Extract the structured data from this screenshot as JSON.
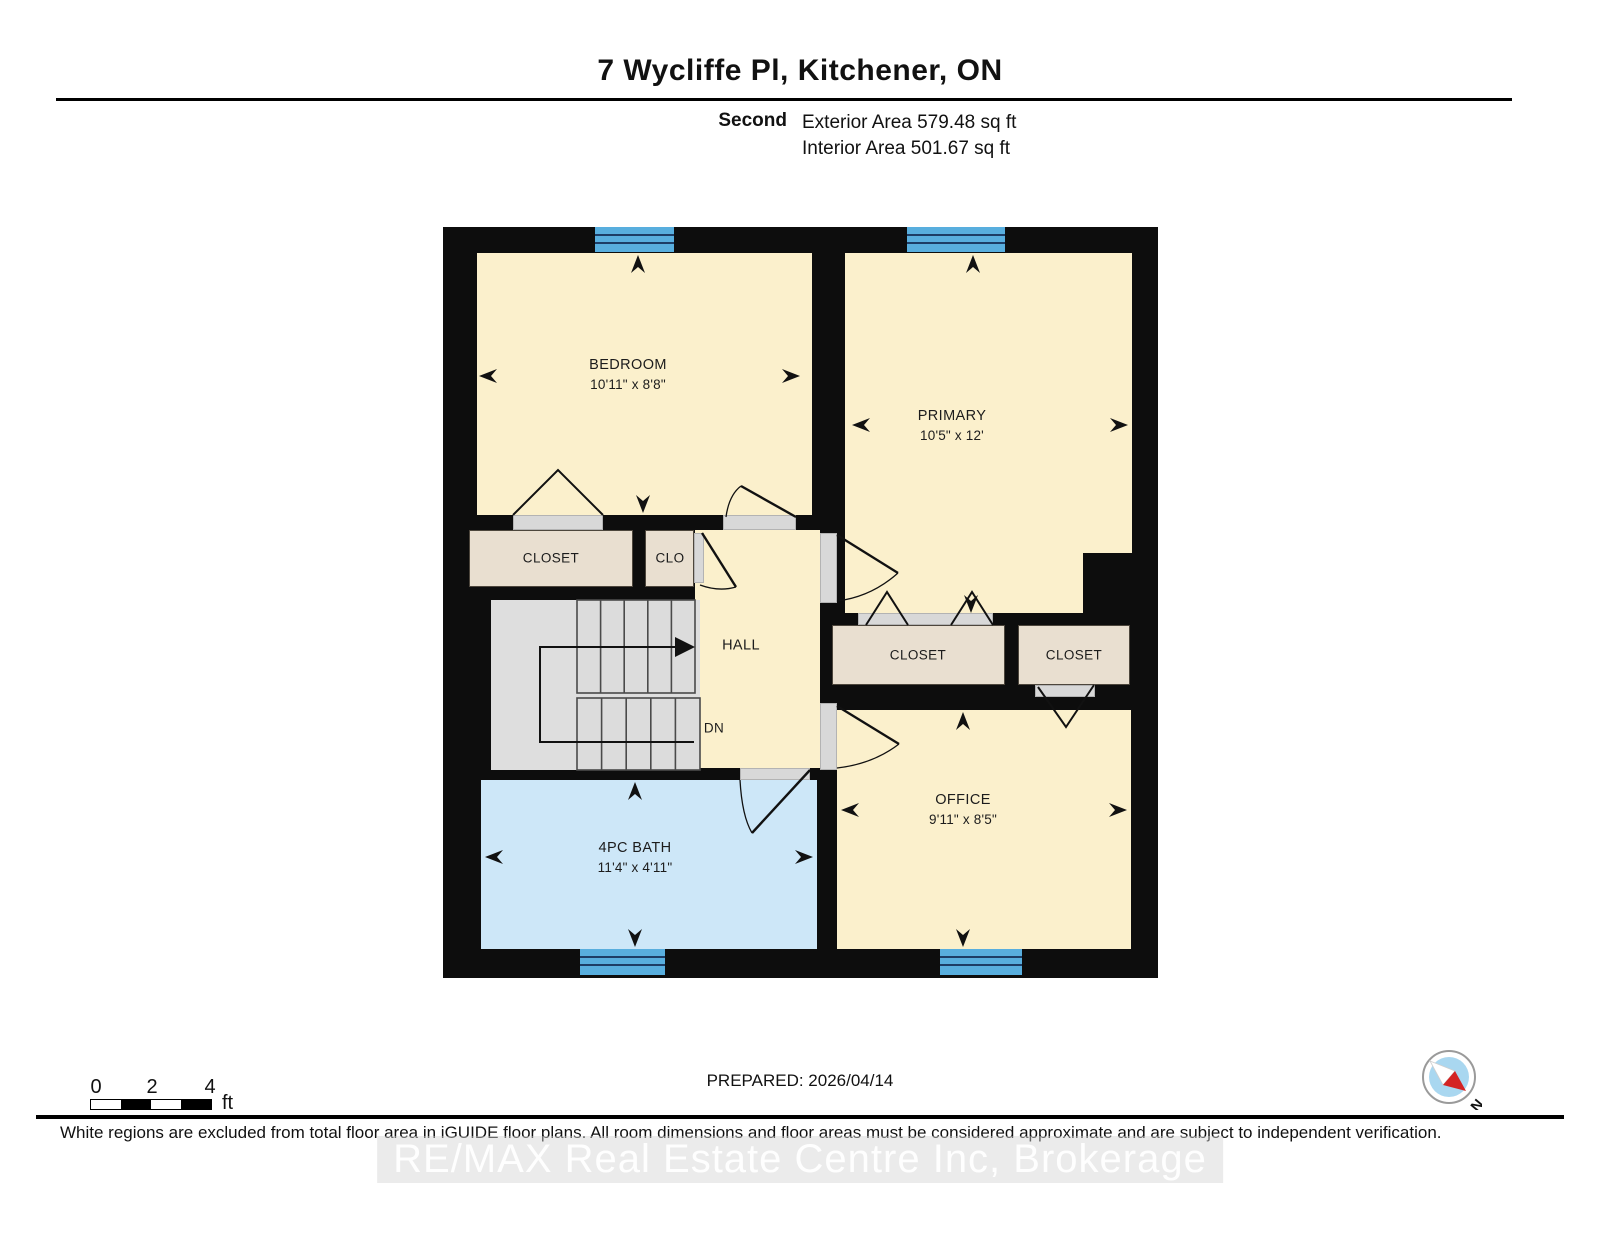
{
  "header": {
    "title": "7 Wycliffe Pl, Kitchener, ON",
    "floor_label": "Second",
    "exterior_area": "Exterior Area 579.48 sq ft",
    "interior_area": "Interior Area 501.67 sq ft"
  },
  "rooms": {
    "bedroom": {
      "name": "BEDROOM",
      "dims": "10'11\" x 8'8\""
    },
    "primary": {
      "name": "PRIMARY",
      "dims": "10'5\" x 12'"
    },
    "office": {
      "name": "OFFICE",
      "dims": "9'11\" x 8'5\""
    },
    "bath": {
      "name": "4PC BATH",
      "dims": "11'4\" x 4'11\""
    },
    "hall": {
      "name": "HALL"
    },
    "stairs_direction": "DN",
    "closet_left": "CLOSET",
    "closet_small": "CLO",
    "closet_mid": "CLOSET",
    "closet_right": "CLOSET"
  },
  "scale_bar": {
    "ticks": [
      "0",
      "2",
      "4"
    ],
    "unit": "ft"
  },
  "compass": {
    "label": "N"
  },
  "footer": {
    "prepared": "PREPARED: 2026/04/14",
    "disclaimer": "White regions are excluded from total floor area in iGUIDE floor plans. All room dimensions and floor areas must be considered approximate and are subject to independent verification.",
    "watermark": "RE/MAX Real Estate Centre Inc, Brokerage"
  },
  "colors": {
    "wall": "#0d0d0d",
    "room_fill": "#fbf0cc",
    "bath_fill": "#cde7f8",
    "closet_fill": "#e9dfd0",
    "stairs_fill": "#dedede",
    "window_fill": "#58aede",
    "window_line": "#1d3d66",
    "compass_needle": "#d42323"
  }
}
